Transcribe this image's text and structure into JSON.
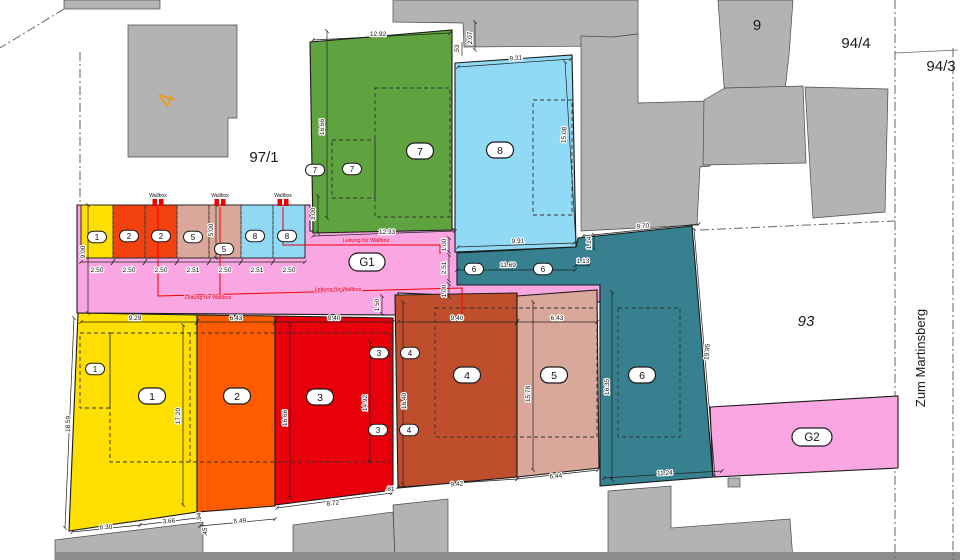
{
  "plan": {
    "street_label": "Zum Martinsberg",
    "wallbox_label": "Wallbox",
    "wire_label": "Leitung für Wallbox",
    "parcel_numbers": {
      "p97_1": "97/1",
      "p9": "9",
      "p94_4": "94/4",
      "p94_3": "94/3",
      "p93": "93",
      "building4": "4"
    },
    "garage_labels": {
      "g1": "G1",
      "g2": "G2"
    },
    "unit_numbers": {
      "u1": "1",
      "u2": "2",
      "u3": "3",
      "u4": "4",
      "u5": "5",
      "u6": "6",
      "u7": "7",
      "u8": "8"
    },
    "dimensions": {
      "d12_92": "12.92",
      "d0_53": ".53",
      "d2_07": "2.07",
      "d9_31": "9.31",
      "d15_08": "15.08",
      "d16_66": "16.66",
      "d3_00": "3.00",
      "d12_33": "12.33",
      "d9_91": "9.91",
      "d9_70": "9.70",
      "d1_14": "1.14",
      "d1_13": "1.13",
      "d11_69": "11.69",
      "d2_51": "2.51",
      "d2_50": "2.50",
      "d1_00": "1.00",
      "d9_00": "9.00",
      "d5_00": "5.00",
      "d1_50": "1.50",
      "d9_29": "9.29",
      "d6_43": "6.43",
      "d9_40": "9.40",
      "d18_59": "18.59",
      "d17_20": "17.20",
      "d14_92": "14.92",
      "d16_40": "16.40",
      "d15_78": "15.78",
      "d16_35": "16.35",
      "d19_95": "19.95",
      "d11_24": "11.24",
      "d9_42": "9.42",
      "d6_44": "6.44",
      "d8_72": "8.72",
      "d0_81": ".81",
      "d5_49": "5.49",
      "d0_94": ".94",
      "d0_45": ".45",
      "d6_30": "6.30",
      "d3_66": "3.66"
    },
    "colors": {
      "unit1": "#ffdf00",
      "unit2": "#ff5c00",
      "unit3": "#e8000a",
      "unit4": "#bf4f2c",
      "unit5": "#d9a89a",
      "unit6": "#36808f",
      "unit7": "#5ea33f",
      "unit8": "#90daf5",
      "stall2": "#f34210",
      "garage_pink": "#f9a6e3",
      "building_gray": "#b3b3b3",
      "road_gray": "#8d8d8d",
      "wire_red": "#f10000",
      "label4_orange": "#f09a1e"
    }
  }
}
